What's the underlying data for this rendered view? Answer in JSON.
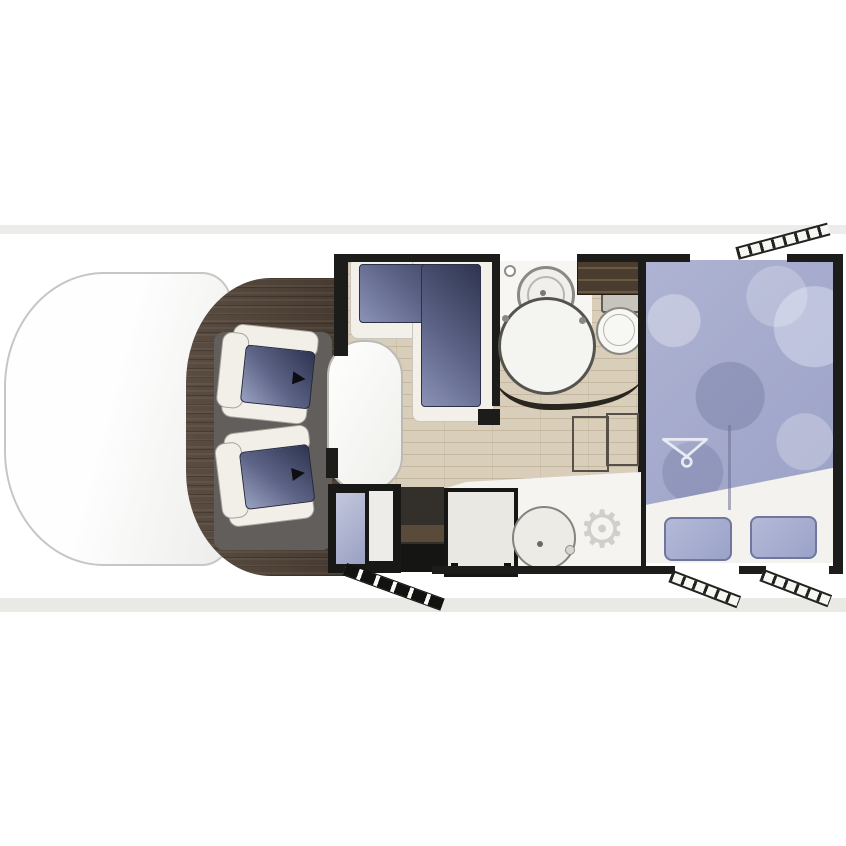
{
  "document": {
    "title": "Motorhome floor plan (top view)",
    "background_color": "#ffffff",
    "band_color": "#ecedea"
  },
  "palette": {
    "wall": "#1c1c1a",
    "cab_wood_floor": "#50433a",
    "interior_floor": "#d9ceb9",
    "cushion_navy": "#3a4160",
    "bed_blue": "#a7adcf",
    "counter_white": "#f5f4f1",
    "seat_frame": "#f1efe8",
    "mat_gray": "#615e5c"
  },
  "icons": {
    "seat_arrow_glyph": "▶",
    "fan_vent_glyph": "⚙",
    "hanger": "clothes-hanger"
  },
  "vehicle": {
    "cab": {
      "name": "Cab with two swivel captain seats",
      "driver_seat": "Driver swivel seat",
      "passenger_seat": "Passenger swivel seat"
    },
    "lounge": {
      "name": "Lounge / dinette",
      "bench": "L-shaped bench seat",
      "table": "Pedestal table"
    },
    "kitchen": {
      "name": "Kitchen",
      "fridge": "Fridge / cabinet unit",
      "stove": "Hob with oven",
      "sink": "Round sink",
      "vent": "Vent fan",
      "worktop": "Worktop",
      "entry_step": "Entrance step well"
    },
    "bathroom": {
      "name": "Washroom",
      "washbasin": "Round washbasin",
      "shower": "Shower cubicle",
      "toilet": "Toilet",
      "wardrobe": "Wardrobe shelves"
    },
    "bedroom": {
      "name": "Rear bedroom",
      "bed": "Island double bed (mattress corner folded)",
      "under_bed": "Wardrobe under bed (hanger symbol)",
      "steps": "Bed access steps",
      "drawer_left": "Storage drawer left",
      "drawer_right": "Storage drawer right"
    },
    "openings": {
      "entry_door": "Entrance door (bottom left of habitation)",
      "window_top_right": "Opened window (top right)",
      "window_bottom_right_1": "Window (bottom right, left)",
      "window_bottom_right_2": "Window (bottom right, right)"
    }
  }
}
